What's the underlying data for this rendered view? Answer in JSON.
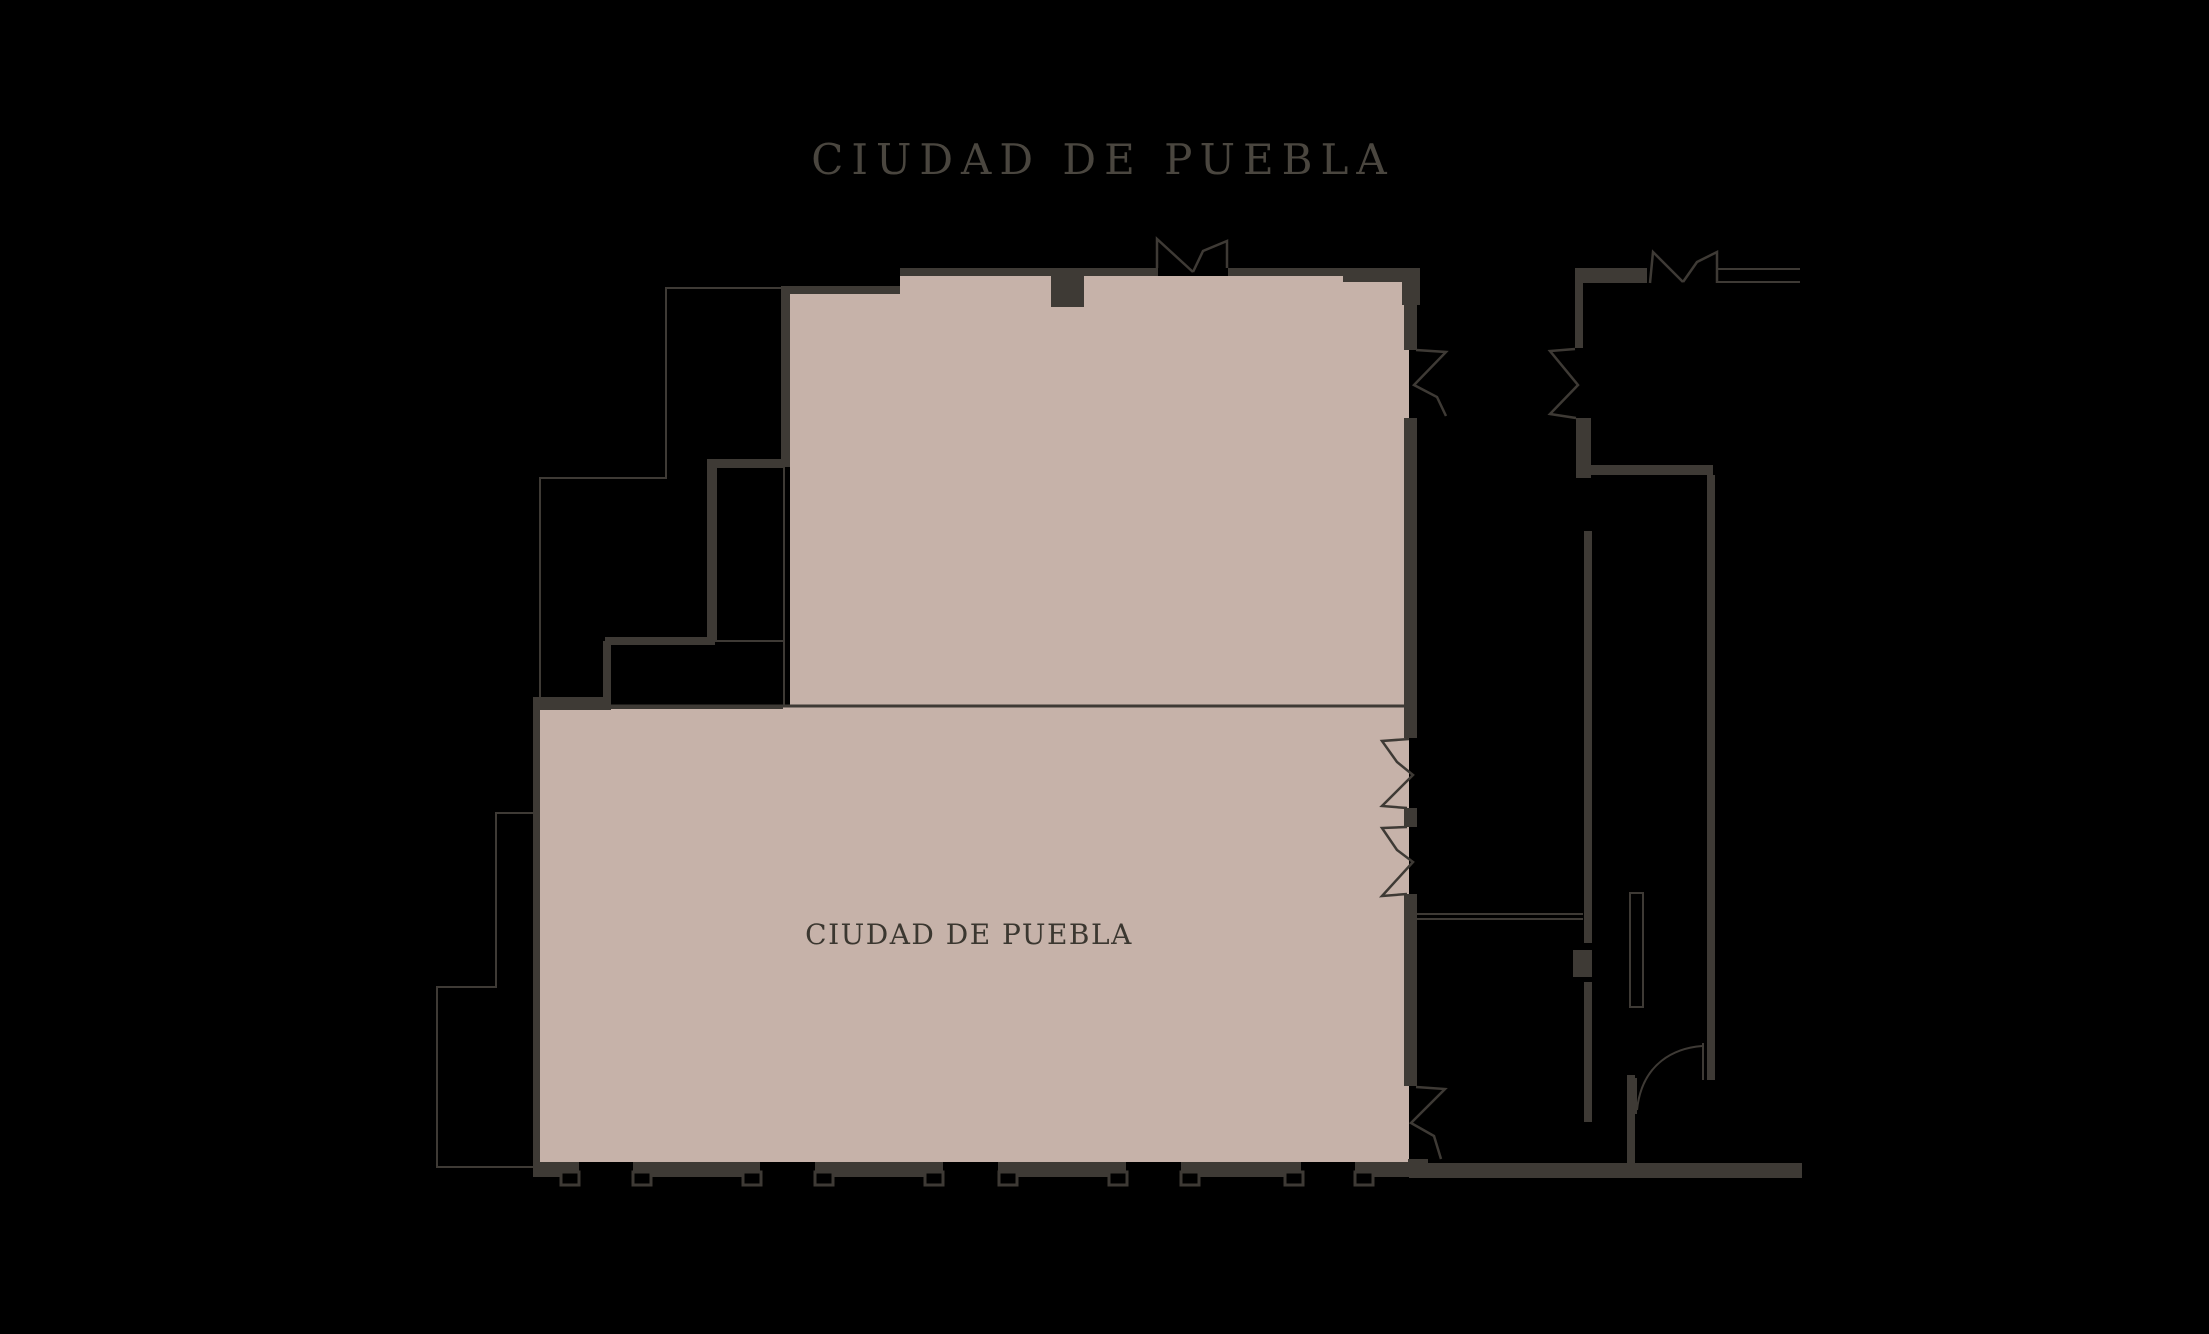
{
  "page": {
    "title": "CIUDAD DE PUEBLA"
  },
  "plan": {
    "room_label": "CIUDAD DE PUEBLA",
    "colors": {
      "bg": "#000000",
      "wall": "#3e3a35",
      "room": "#c6b2a9",
      "title": "#4a463f",
      "label": "#3b3730"
    }
  }
}
